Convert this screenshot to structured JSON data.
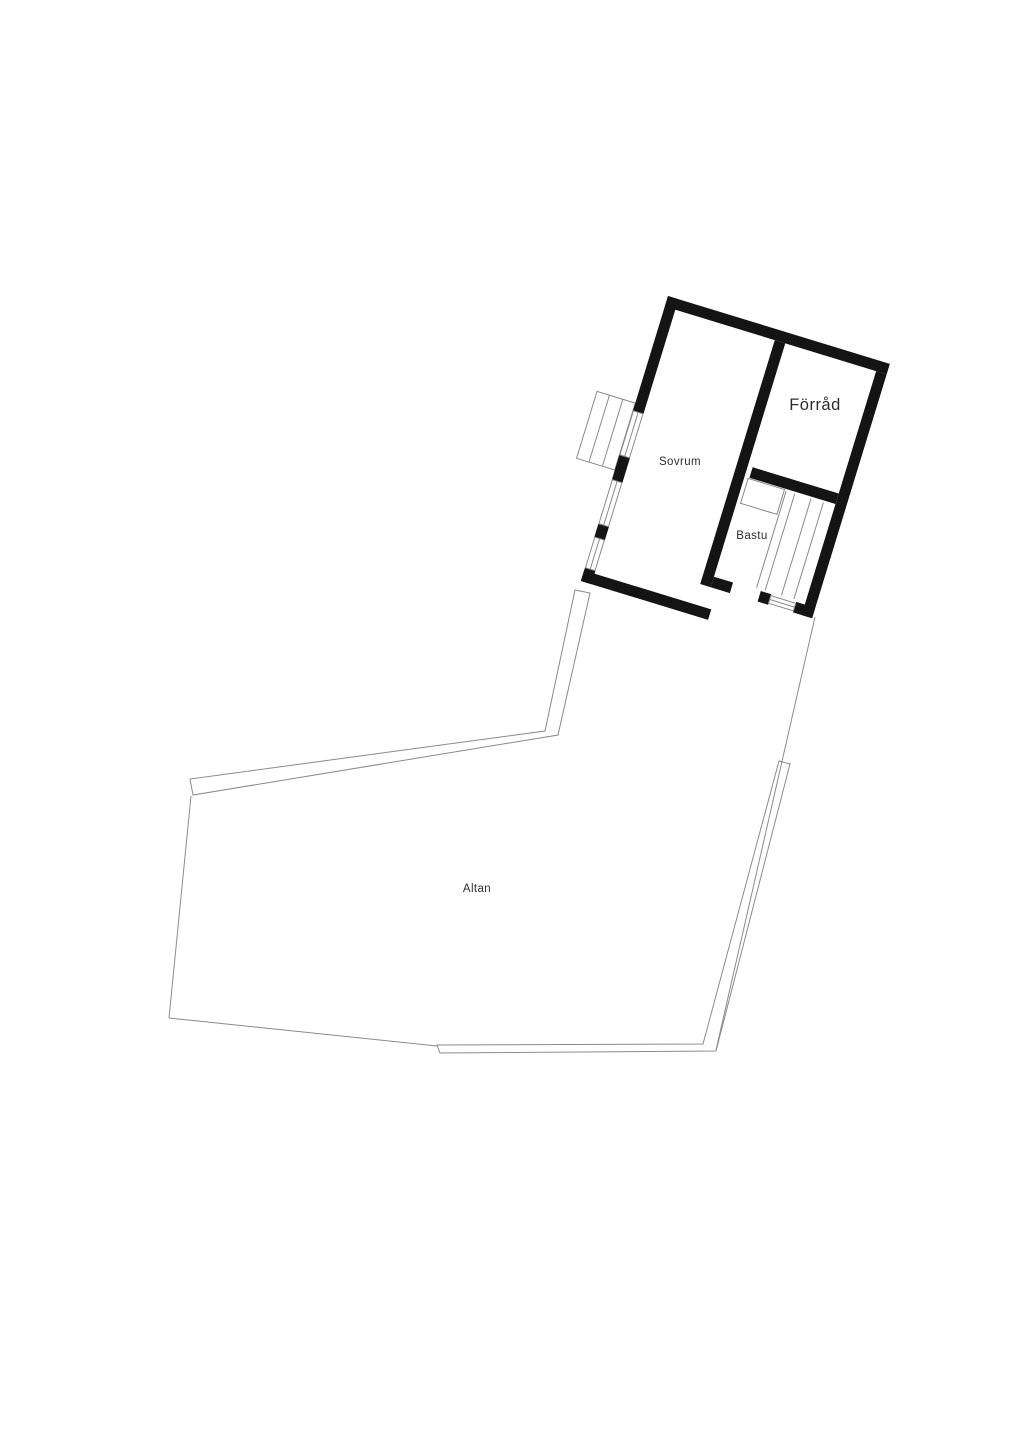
{
  "colors": {
    "wall": "#141414",
    "thin_line": "#8a8a8a",
    "text": "#2d2d2d",
    "background": "#ffffff"
  },
  "rooms": {
    "sovrum": {
      "label": "Sovrum"
    },
    "forrad": {
      "label": "Förråd"
    },
    "bastu": {
      "label": "Bastu"
    },
    "altan": {
      "label": "Altan"
    }
  }
}
